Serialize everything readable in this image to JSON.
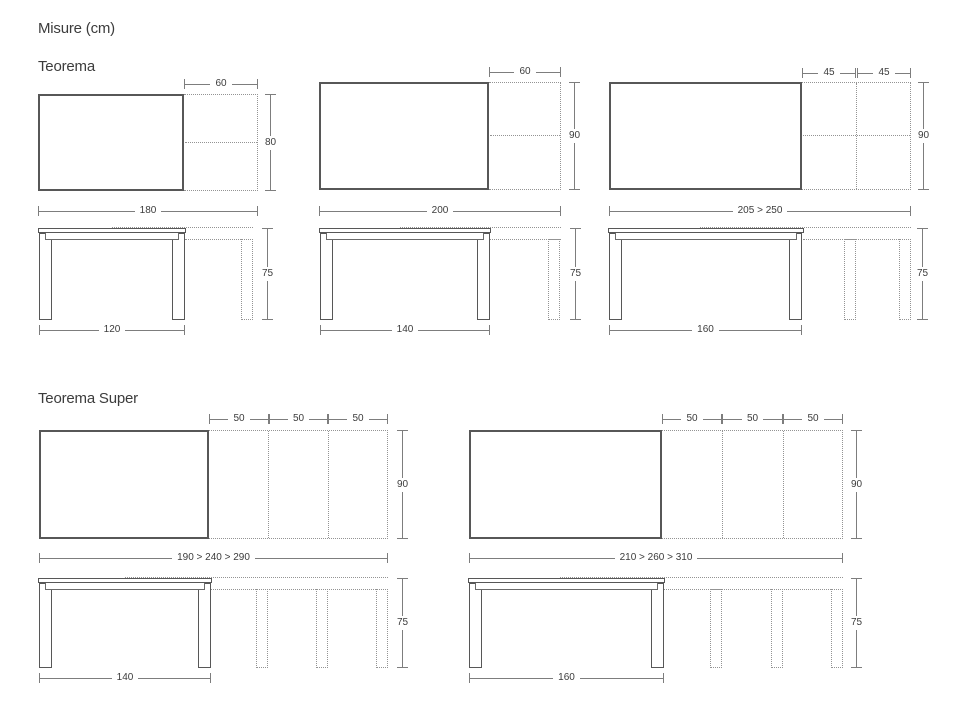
{
  "page": {
    "title": "Misure (cm)"
  },
  "colors": {
    "background": "#ffffff",
    "solid_line": "#575757",
    "dashed_line": "#939393",
    "dim_line": "#7d7d7d",
    "text": "#3c3c3c"
  },
  "sections": [
    {
      "title": "Teorema",
      "diagrams": [
        {
          "ext_dims": [
            "60"
          ],
          "depth": "80",
          "length": "180",
          "front_width": "120",
          "height": "75"
        },
        {
          "ext_dims": [
            "60"
          ],
          "depth": "90",
          "length": "200",
          "front_width": "140",
          "height": "75"
        },
        {
          "ext_dims": [
            "45",
            "45"
          ],
          "depth": "90",
          "length": "205 > 250",
          "front_width": "160",
          "height": "75"
        }
      ]
    },
    {
      "title": "Teorema Super",
      "diagrams": [
        {
          "ext_dims": [
            "50",
            "50",
            "50"
          ],
          "depth": "90",
          "length": "190 > 240 > 290",
          "front_width": "140",
          "height": "75"
        },
        {
          "ext_dims": [
            "50",
            "50",
            "50"
          ],
          "depth": "90",
          "length": "210 > 260 > 310",
          "front_width": "160",
          "height": "75"
        }
      ]
    }
  ]
}
